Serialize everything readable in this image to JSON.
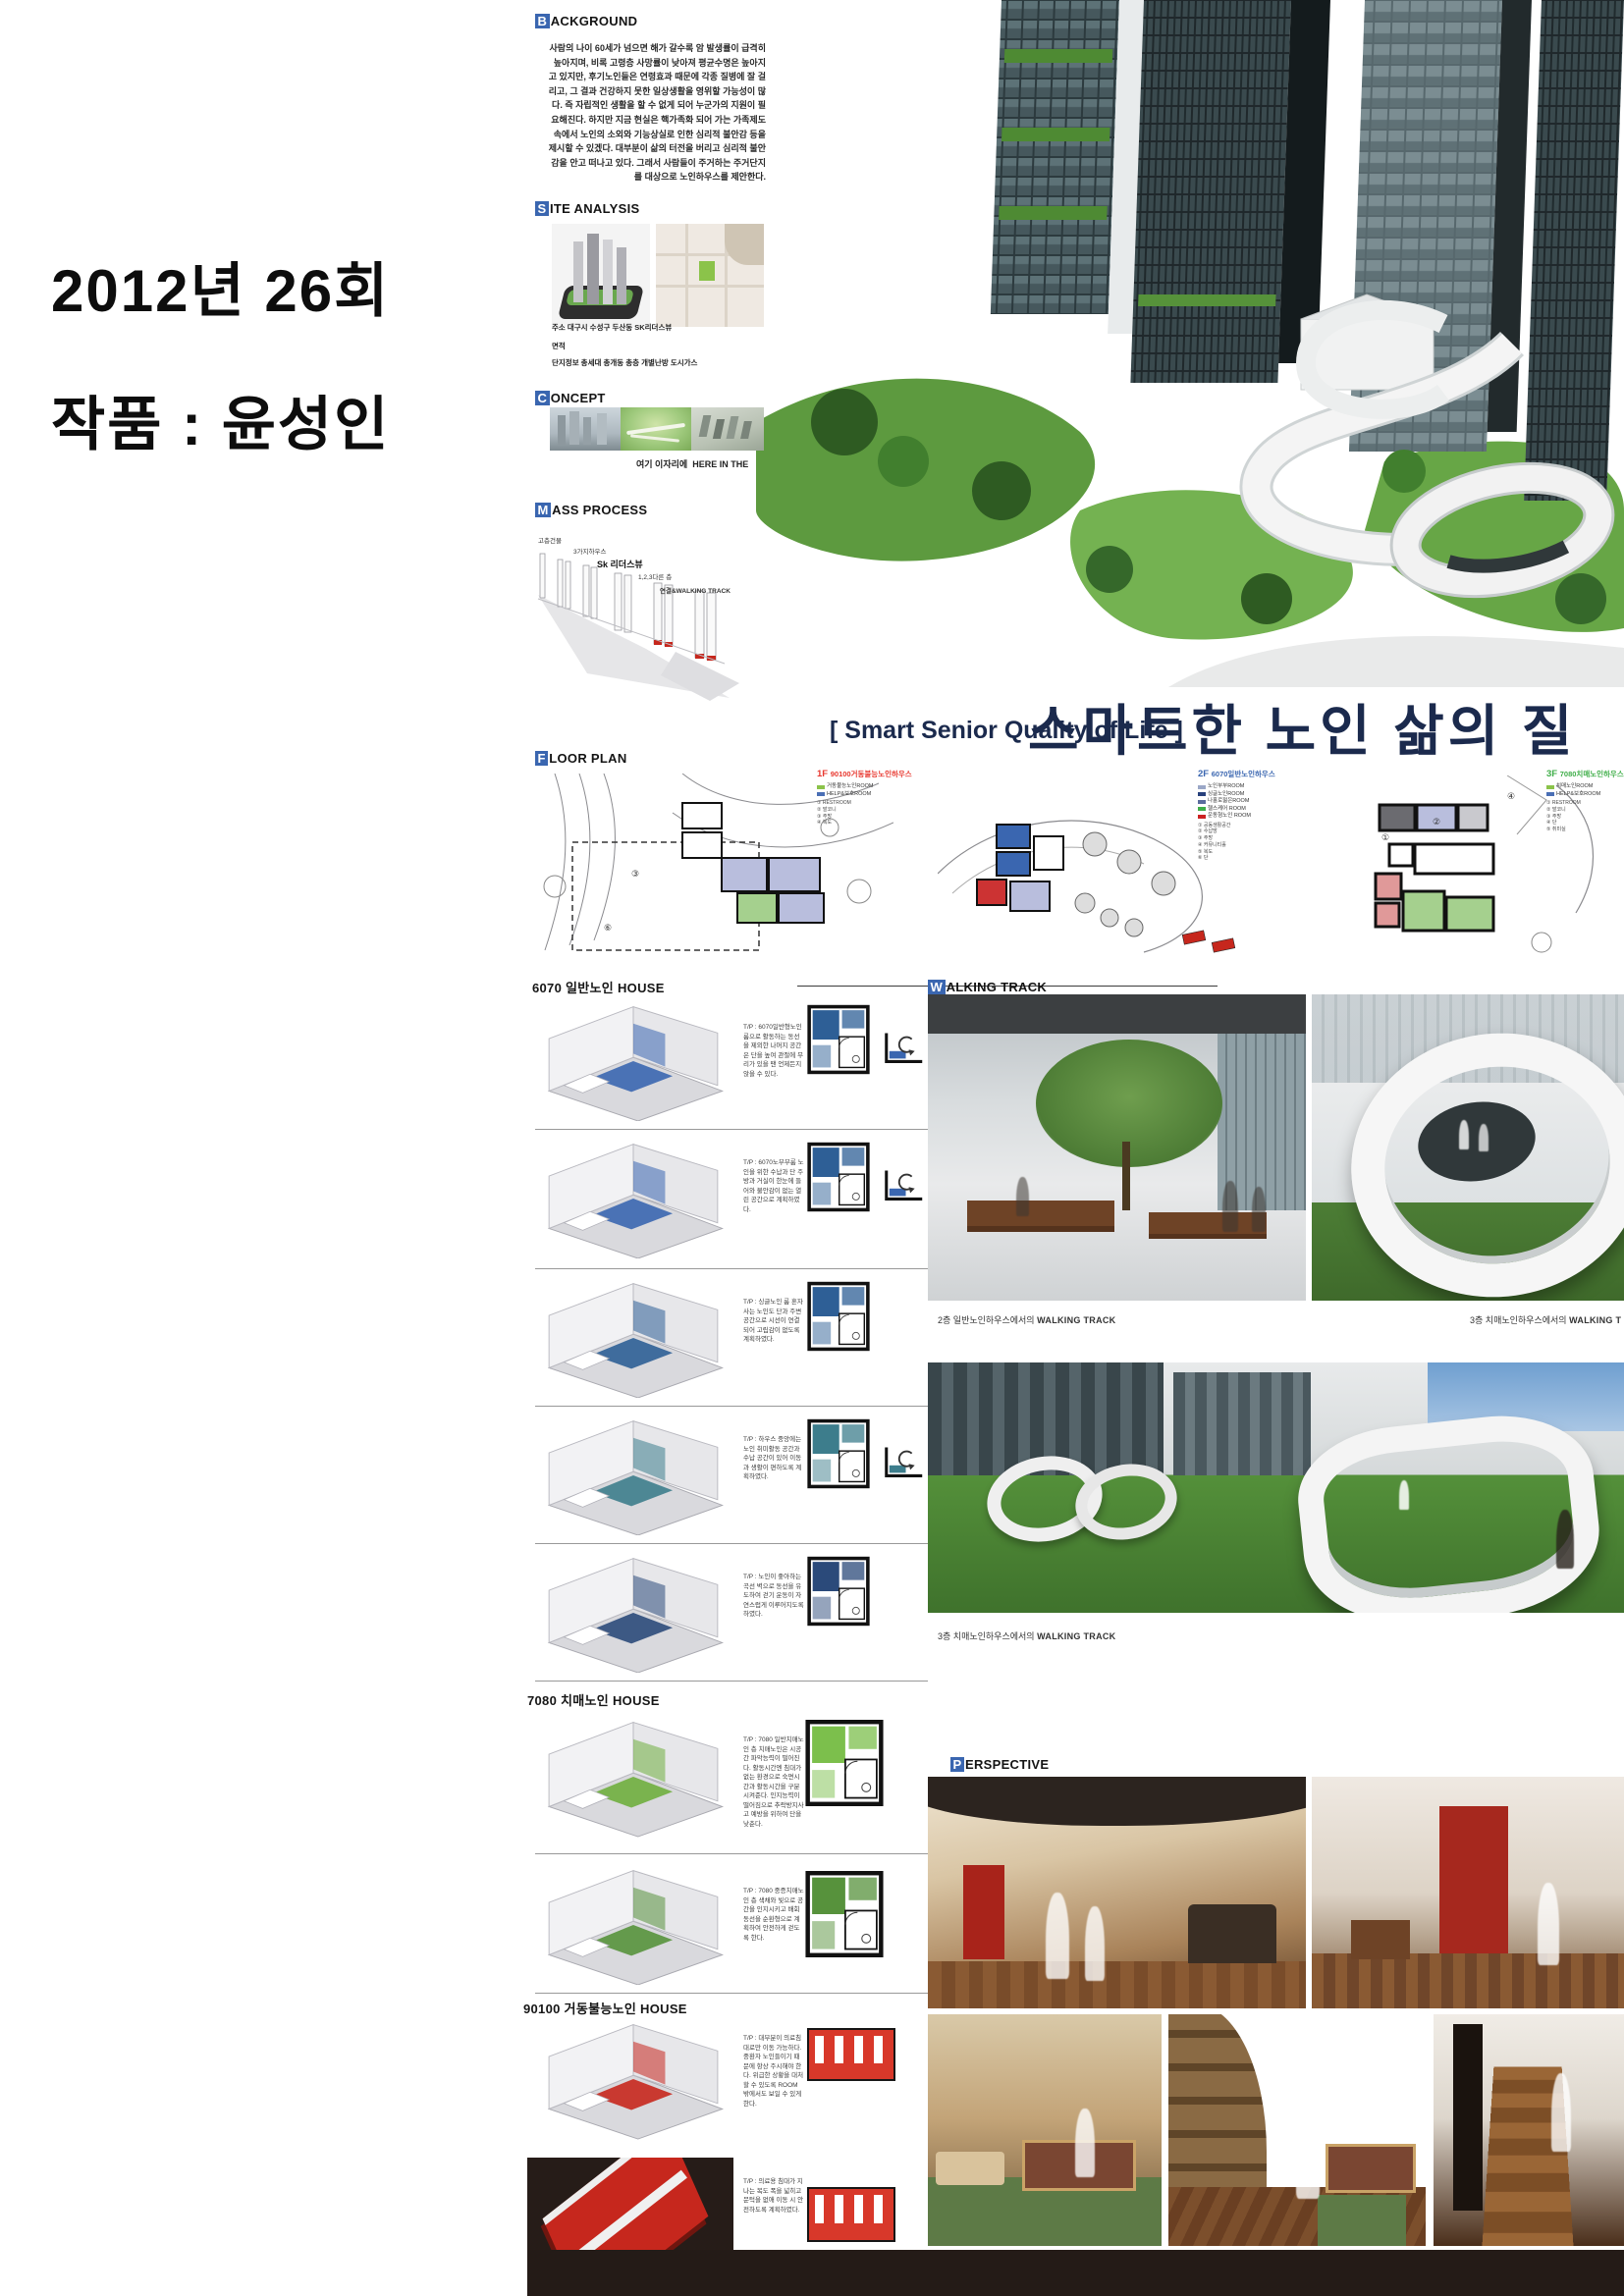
{
  "colors": {
    "accent_blue": "#3a66b0",
    "accent_red": "#e8382f",
    "accent_green": "#3fae49",
    "navy": "#1b2a4d",
    "bar": "#241b17"
  },
  "left_panel": {
    "line1": "2012년 26회",
    "line2": "작품 : 윤성인"
  },
  "board": {
    "background": {
      "cap": "B",
      "rest": "ACKGROUND",
      "text": "사람의 나이 60세가 넘으면 해가 갈수록 암 발생률이 급격히 높아지며, 비록 고령층 사망률이 낮아져 평균수명은 높아지고 있지만, 후기노인들은 연령효과 때문에 각종 질병에 잘 걸리고, 그 결과 건강하지 못한 일상생활을 영위할 가능성이 많다. 즉 자립적인 생활을 할 수 없게 되어 누군가의 지원이 필요해진다. 하지만 지금 현실은 핵가족화 되어 가는 가족제도 속에서 노인의 소외와 기능상실로 인한 심리적 불안감 등을 제시할 수 있겠다. 대부분이 삶의 터전을 버리고 심리적 불안감을 안고 떠나고 있다. 그래서 사람들이 주거하는 주거단지를 대상으로 노인하우스를 제안한다."
    },
    "site": {
      "cap": "S",
      "rest": "ITE ANALYSIS",
      "lines": [
        "주소 대구시 수성구 두산동 SK리더스뷰",
        "면적",
        "단지정보 총세대 총개동 총층 개별난방 도시가스"
      ]
    },
    "concept": {
      "cap": "C",
      "rest": "ONCEPT",
      "caption_kr": "여기 이자리에",
      "caption_en": "HERE IN THE"
    },
    "mass": {
      "cap": "M",
      "rest": "ASS PROCESS",
      "labels": [
        "고층건물",
        "3가지하우스",
        "Sk 리더스뷰",
        "1,2,3다른 층",
        "연결&WALKING TRACK"
      ]
    },
    "title": {
      "en": "[ Smart Senior Quality of Life ]",
      "kr": "스마트한 노인 삶의 질"
    },
    "floorplan": {
      "cap": "F",
      "rest": "LOOR PLAN",
      "plans": [
        {
          "code": "1F",
          "name": "90100거동불능노인하우스",
          "legend": [
            "거동불능노인ROOM",
            "HELP&보호ROOM"
          ],
          "notes": "① RESTROOM\n② 발코니\n③ 주방\n④ 복도"
        },
        {
          "code": "2F",
          "name": "6070일반노인하우스",
          "legend": [
            "노인부부ROOM",
            "싱글노인ROOM",
            "나홀로젊은ROOM",
            "헬스케어 ROOM",
            "운동형노인 ROOM"
          ],
          "notes": "① 공동생활공간\n② 수납방\n③ 주방\n④ 커뮤니티홀\n⑤ 복도\n⑥ 단"
        },
        {
          "code": "3F",
          "name": "7080치매노인하우스",
          "legend": [
            "치매노인ROOM",
            "HELP&보호ROOM"
          ],
          "notes": "① RESTROOM\n② 발코니\n③ 주방\n④ 단\n⑤ 취미실"
        }
      ]
    },
    "walking": {
      "cap": "W",
      "rest": "ALKING TRACK",
      "captions": [
        {
          "pre": "2층 일반노인하우스에서의 ",
          "bold": "WALKING TRACK"
        },
        {
          "pre": "3층 치매노인하우스에서의 ",
          "bold": "WALKING T"
        },
        {
          "pre": "3층 치매노인하우스에서의 ",
          "bold": "WALKING TRACK"
        }
      ]
    },
    "perspective": {
      "cap": "P",
      "rest": "ERSPECTIVE"
    },
    "h6070": {
      "title": "6070 일반노인 HOUSE",
      "entries": [
        {
          "tip": "T/P : 6070일반형노인 룸으로 활동하는 동선을 제외한 나머지 공간은 단을 높여 관절에 무리가 있을 땐 언제든지 앉을 수 있다."
        },
        {
          "tip": "T/P : 6070노부부룸 노인을 위한 수납과 단 주방과 거실이 한눈에 들어와 불안감이 없는 열린 공간으로 계획하였다."
        },
        {
          "tip": "T/P : 싱글노인 룸 혼자 사는 노인도 단과 주변 공간으로 시선이 연결되어 고립감이 없도록 계획하였다."
        },
        {
          "tip": "T/P : 하우스 중앙에는 노인 취미활동 공간과 수납 공간이 있어 이동과 생활이 편하도록 계획하였다."
        },
        {
          "tip": "T/P : 노인이 좋아하는 곡선 벽으로 동선을 유도하여 걷기 운동이 자연스럽게 이루어지도록 하였다."
        }
      ]
    },
    "h7080": {
      "title": "7080 치매노인 HOUSE",
      "entries": [
        {
          "tip": "T/P : 7080 일반치매노인 층 치매노인은 시공간 파악능력이 떨어진다. 활동시간엔 침대가 없는 환경으로 숙면시간과 활동시간을 구분시켜준다. 인지능력이 떨어짐으로 추락방지사고 예방을 위하여 단을 낮춘다."
        },
        {
          "tip": "T/P : 7080 중증치매노인 층 색채와 빛으로 공간을 인지시키고 배회 동선을 순환형으로 계획하여 안전하게 걷도록 한다."
        }
      ]
    },
    "h90100": {
      "title": "90100 거동불능노인 HOUSE",
      "entries": [
        {
          "tip": "T/P : 대부분이 의료침대로만 이동 가능하다. 중환자 노인들이기 때문에 항상 주시해야 한다. 위급한 상황을 대처할 수 있도록 ROOM 밖에서도 보일 수 있게 한다."
        },
        {
          "tip": "T/P : 의료용 침대가 지나는 복도 폭을 넓히고 문턱을 없애 이동 시 안전하도록 계획하였다."
        }
      ]
    }
  }
}
